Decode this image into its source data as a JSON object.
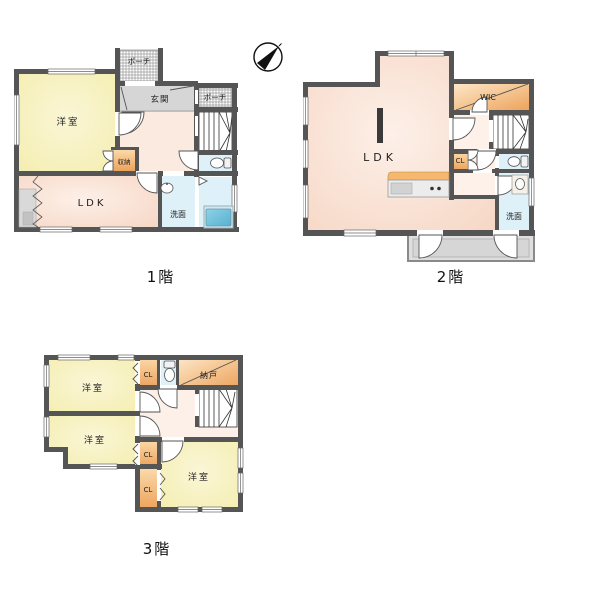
{
  "title": "3-story house floor plan",
  "compass": {
    "icon": "north-arrow"
  },
  "colors": {
    "wall": "#555555",
    "room_yellow": "#f8f3c4",
    "room_pink": "#f8dcca",
    "hall_peach": "#fbeadf",
    "entry_gray": "#d6d6d6",
    "closet_orange_top": "#fbd9a9",
    "closet_orange_bottom": "#eda35c",
    "wet_blue": "#def1f8",
    "tub_blue": "#63bad6",
    "balcony_gray": "#dedede",
    "stairs_frame": "#333333"
  },
  "icons": {
    "compass": "north-arrow",
    "toilet": "toilet-icon",
    "sink": "sink-icon",
    "tub": "bathtub-icon",
    "stairs": "stairs-icon",
    "kitchen": "kitchen-counter-icon"
  },
  "floor1": {
    "label": "1階",
    "rooms": {
      "yoshitsu": "洋室",
      "ldk": "LDK",
      "genkan": "玄関",
      "porch_top": "ポーチ",
      "porch_right": "ポーチ",
      "shuno": "収納",
      "senmen": "洗面"
    }
  },
  "floor2": {
    "label": "2階",
    "rooms": {
      "ldk": "LDK",
      "wic": "WIC",
      "cl": "CL",
      "senmen": "洗面"
    }
  },
  "floor3": {
    "label": "3階",
    "rooms": {
      "yoshitsu1": "洋室",
      "yoshitsu2": "洋室",
      "yoshitsu3": "洋室",
      "cl_top": "CL",
      "cl_mid": "CL",
      "cl_low": "CL",
      "nando": "納戸"
    }
  }
}
